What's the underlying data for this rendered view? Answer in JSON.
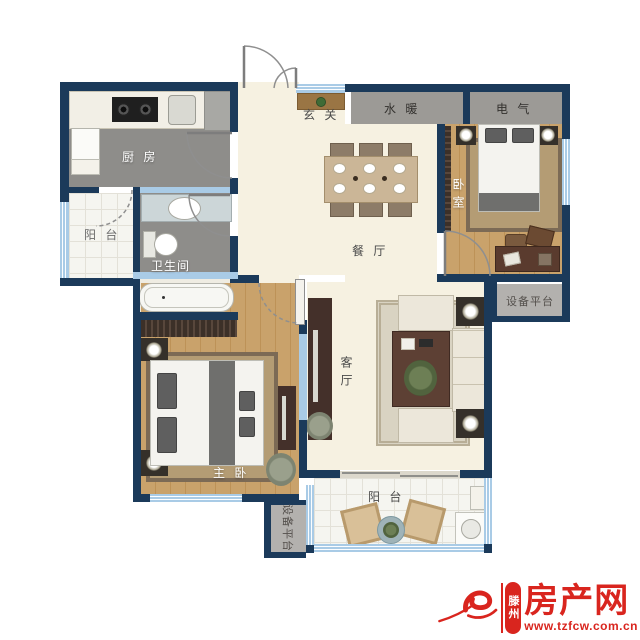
{
  "rooms": {
    "kitchen": {
      "label": "厨 房"
    },
    "balcony_left": {
      "label": "阳 台"
    },
    "bathroom": {
      "label": "卫生间"
    },
    "entry": {
      "label": "玄 关"
    },
    "plumbing": {
      "label": "水 暖"
    },
    "electrical": {
      "label": "电 气"
    },
    "bedroom": {
      "label": "卧室"
    },
    "equipment_right": {
      "label": "设备平台"
    },
    "dining": {
      "label": "餐 厅"
    },
    "living": {
      "label": "客厅"
    },
    "master_bedroom": {
      "label": "主 卧"
    },
    "balcony_bottom": {
      "label": "阳 台"
    },
    "equipment_bottom": {
      "label": "设备平台"
    }
  },
  "watermark": {
    "city": "滕州",
    "site": "房产网",
    "url": "www.tzfcw.com.cn",
    "brand_color": "#d9251e"
  },
  "palette": {
    "wall": "#1b3a5a",
    "partition": "#a9cbe6",
    "floor_cream": "#f6f1e1",
    "floor_wet": "#8e8d8a",
    "floor_wood": "#c9a26b",
    "service_box": "#9c9a96",
    "platform_box": "#b3b1ae"
  }
}
